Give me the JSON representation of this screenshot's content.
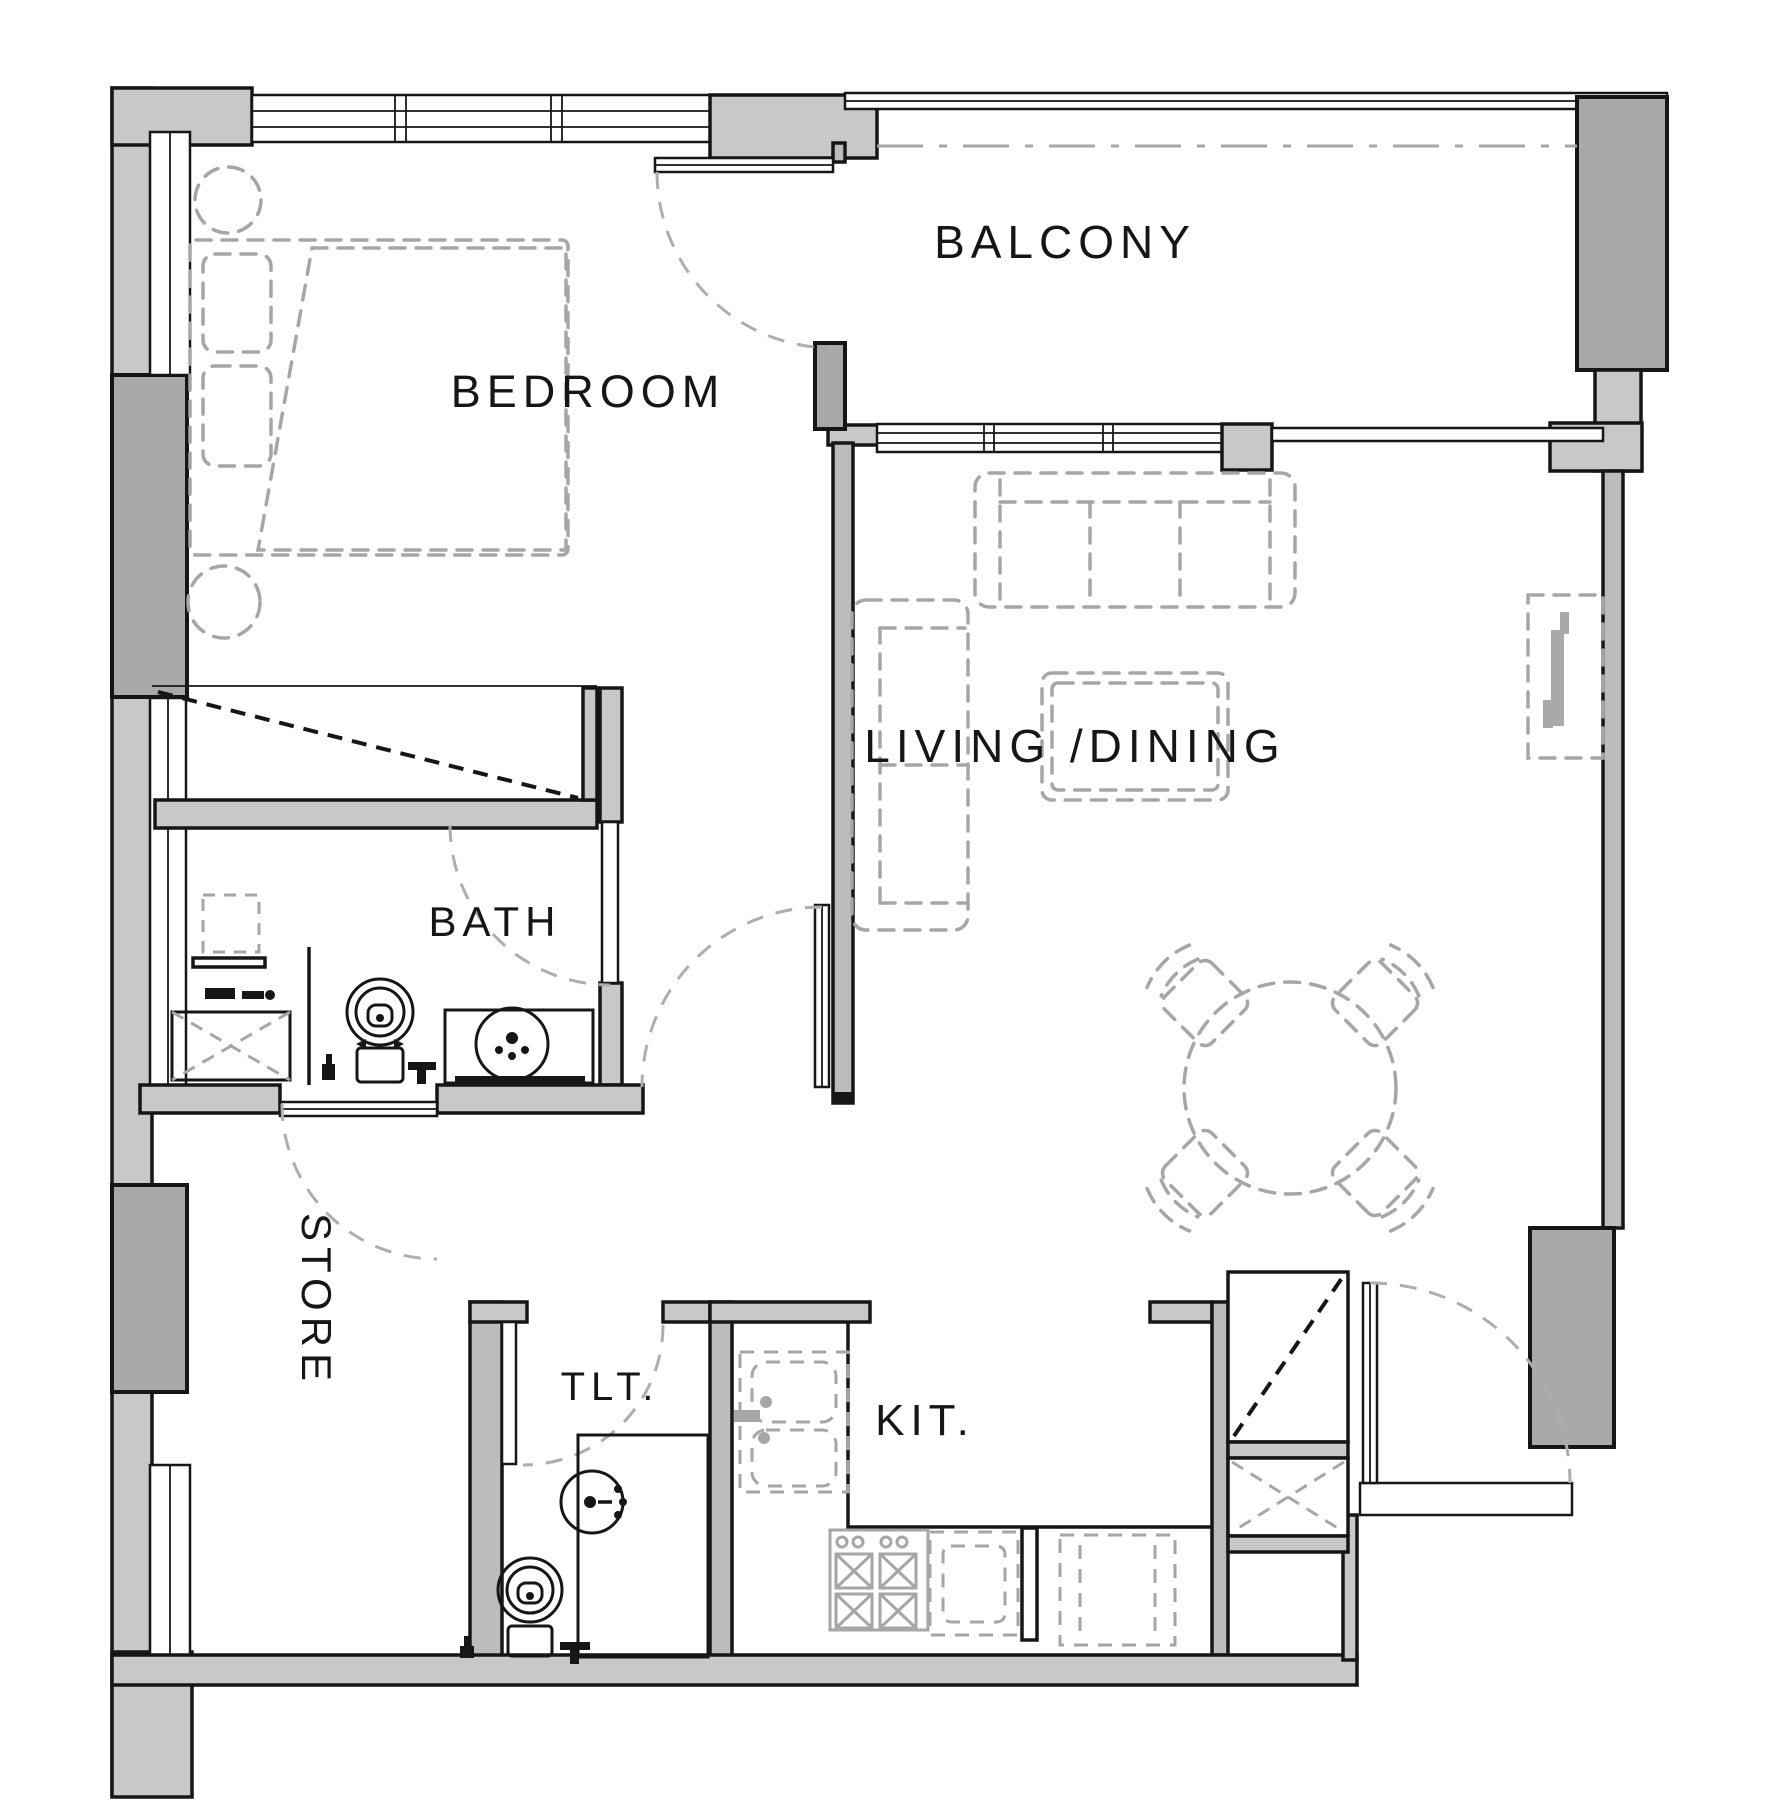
{
  "title": "Apartment Floor Plan",
  "rooms": {
    "balcony": "BALCONY",
    "bedroom": "BEDROOM",
    "living_dining": "LIVING /DINING",
    "bath": "BATH",
    "store": "STORE",
    "toilet": "TLT.",
    "kitchen": "KIT."
  },
  "colors": {
    "background": "#ffffff",
    "line": "#161616",
    "wall_light": "#c8c8c8",
    "wall_dark": "#a9a9a9",
    "wall_mid": "#bcbcbc",
    "furniture": "#a6a6a6",
    "door_arc": "#aeaeae"
  }
}
